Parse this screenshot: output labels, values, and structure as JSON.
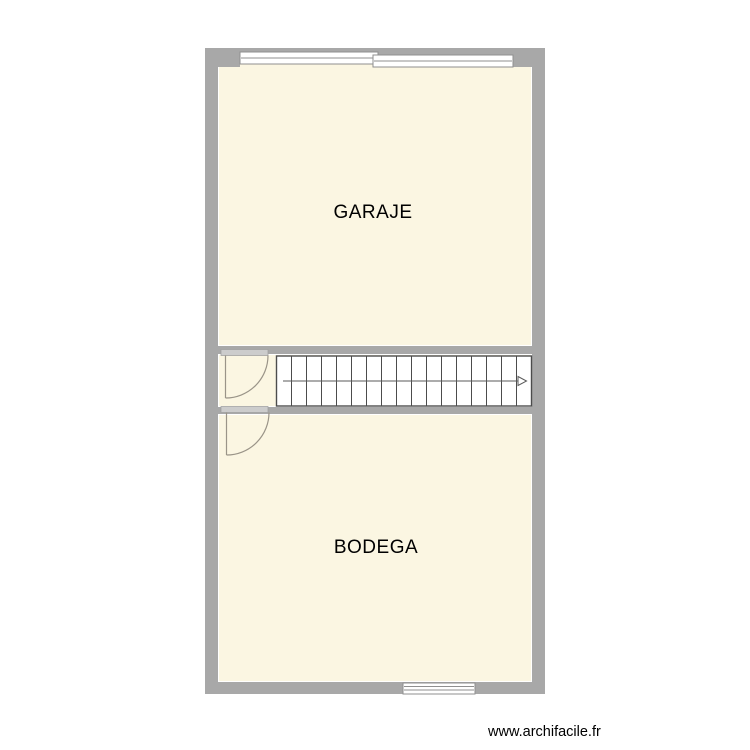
{
  "canvas": {
    "width": 750,
    "height": 750,
    "background": "#ffffff"
  },
  "palette": {
    "wall": "#a8a8a8",
    "room_fill": "#fbf6e2",
    "window_stroke": "#8f8f8f",
    "door_bar": "#cccccc",
    "door_arc": "#9a9488",
    "stair": "#4c4c4c",
    "arrow": "#5a5a5a",
    "label": "#000000"
  },
  "rooms": [
    {
      "id": "garaje",
      "label": "GARAJE"
    },
    {
      "id": "bodega",
      "label": "BODEGA"
    }
  ],
  "stairs": {
    "tread_lines": 16,
    "direction_arrow": "right"
  },
  "doors": [
    {
      "id": "upper-left",
      "swing": "quarter-arc"
    },
    {
      "id": "lower-left",
      "swing": "quarter-arc"
    }
  ],
  "windows": [
    {
      "id": "top-left"
    },
    {
      "id": "top-right"
    },
    {
      "id": "bottom"
    }
  ],
  "watermark": {
    "text": "www.archifacile.fr"
  }
}
